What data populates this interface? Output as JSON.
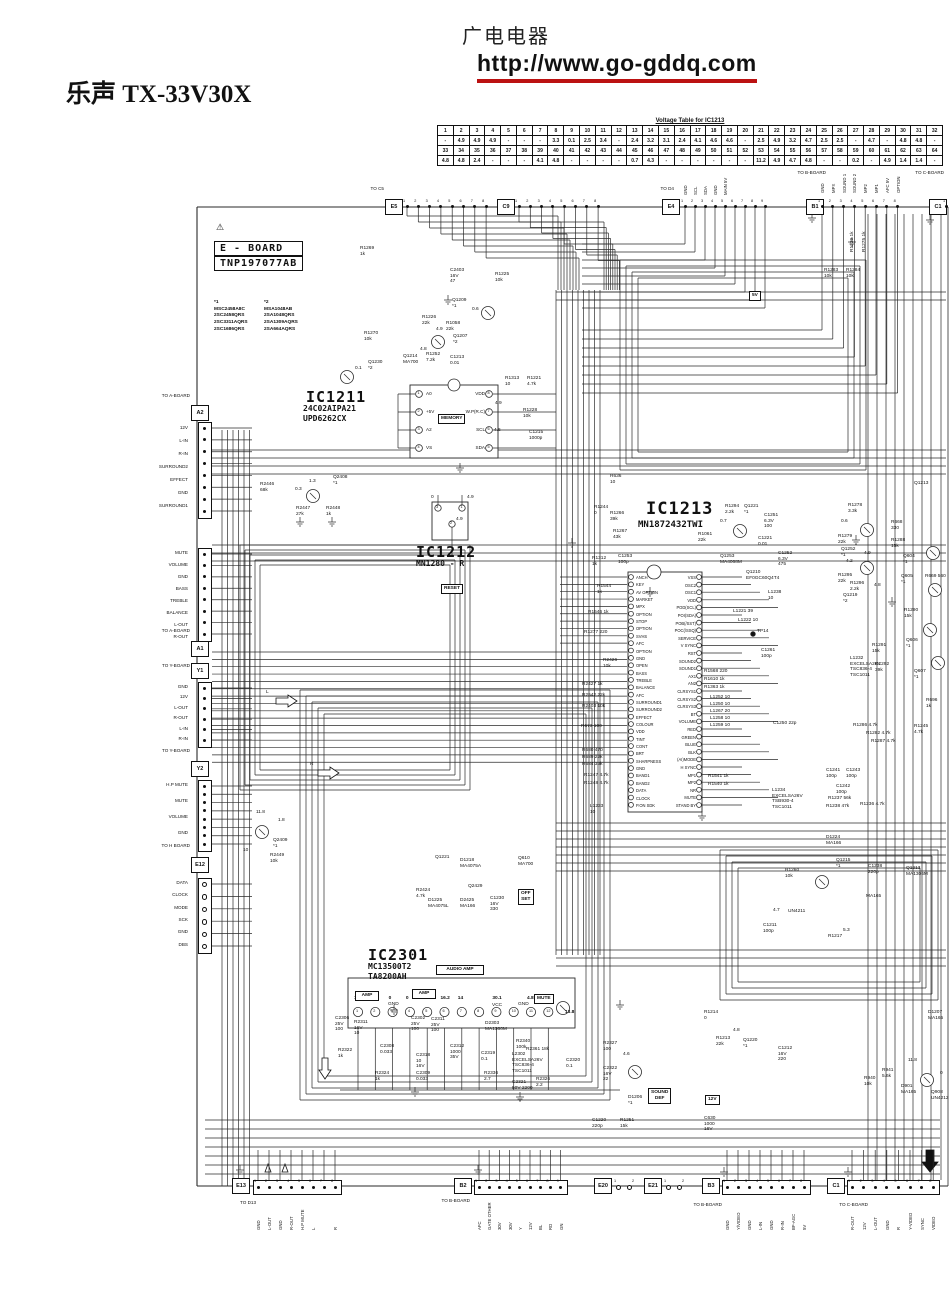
{
  "header": {
    "site_name": "广电电器",
    "site_url": "http://www.go-gddq.com",
    "model_title": "乐声 TX-33V30X"
  },
  "voltage_table": {
    "title": "Voltage Table for IC1213",
    "pins_row1": [
      "1",
      "2",
      "3",
      "4",
      "5",
      "6",
      "7",
      "8",
      "9",
      "10",
      "11",
      "12",
      "13",
      "14",
      "15",
      "16",
      "17",
      "18",
      "19",
      "20",
      "21",
      "22",
      "23",
      "24",
      "25",
      "26",
      "27",
      "28",
      "29",
      "30",
      "31",
      "32"
    ],
    "volts_row1": [
      "-",
      "4.9",
      "4.9",
      "4.9",
      "-",
      "-",
      "-",
      "3.3",
      "0.1",
      "2.5",
      "3.4",
      "-",
      "2.4",
      "3.2",
      "3.1",
      "2.4",
      "4.1",
      "4.6",
      "4.6",
      "-",
      "2.5",
      "4.9",
      "3.2",
      "4.7",
      "2.5",
      "2.5",
      "-",
      "4.7",
      "-",
      "4.8",
      "4.8",
      "-"
    ],
    "pins_row2": [
      "33",
      "34",
      "35",
      "36",
      "37",
      "38",
      "39",
      "40",
      "41",
      "42",
      "43",
      "44",
      "45",
      "46",
      "47",
      "48",
      "49",
      "50",
      "51",
      "52",
      "53",
      "54",
      "55",
      "56",
      "57",
      "58",
      "59",
      "60",
      "61",
      "62",
      "63",
      "64"
    ],
    "volts_row2": [
      "4.8",
      "4.8",
      "2.4",
      "-",
      "-",
      "-",
      "4.1",
      "4.8",
      "-",
      "-",
      "-",
      "-",
      "0.7",
      "4.3",
      "-",
      "-",
      "-",
      "-",
      "-",
      "-",
      "11.2",
      "4.9",
      "4.7",
      "4.8",
      "-",
      "-",
      "0.2",
      "-",
      "4.9",
      "1.4",
      "1.4",
      "-"
    ]
  },
  "eboard": {
    "warning": "⚠",
    "name": "E - BOARD",
    "part": "TNP197077AB"
  },
  "legend": {
    "c1": {
      "title": "*1",
      "items": [
        "MSC2458A8C",
        "2SC2458QRS",
        "2SC3311AQRS",
        "2SC1686QRS"
      ]
    },
    "c2": {
      "title": "*2",
      "items": [
        "MSA1048AB",
        "2SA1048QRS",
        "2SA1309AQRS",
        "2SA664AQRS"
      ]
    }
  },
  "ic1211": {
    "ref": "IC1211",
    "parts": "24C02AIPA21\nUPD6262CX",
    "left_pins": [
      "A0",
      "+5V",
      "A2",
      "VS"
    ],
    "right_pins": [
      "VDD",
      "W.P(R.C)",
      "SCL",
      "SDA"
    ],
    "left_nums": [
      "1",
      "2",
      "3",
      "4"
    ],
    "right_nums": [
      "8",
      "7",
      "6",
      "5"
    ]
  },
  "ic1212": {
    "ref": "IC1212",
    "part": "MN1280 - R",
    "pins": [
      "3",
      "1",
      "2"
    ],
    "values": [
      "0",
      "4.9",
      "4.9"
    ]
  },
  "ic1213": {
    "ref": "IC1213",
    "part": "MN1872432TWI",
    "left_pins": [
      "ANCH",
      "KEY",
      "AV OPTION",
      "MARKET",
      "MPX",
      "OPTION",
      "STOP",
      "OPTION",
      "SVHS",
      "AFC",
      "OPTION",
      "GND",
      "OPEN",
      "BASS",
      "TREBLE",
      "BALANCE",
      "AFC",
      "SURROUND1",
      "SURROUND2",
      "EFFECT",
      "COLOUR",
      "VDD",
      "TINT",
      "CONT",
      "BRT",
      "SHARPNESS",
      "GND",
      "BAND1",
      "BAND2",
      "DATA",
      "CLOCK",
      "P.ON SDK"
    ],
    "right_pins": [
      "VSS",
      "OSC2",
      "OSC1",
      "VDD",
      "POD(SCL)",
      "POI(SDA)",
      "POB(/SST)",
      "POC(/SSQ)",
      "SERVICE",
      "V SYNC",
      "RST",
      "SOUND2",
      "SOUND1",
      "AX1",
      "AN2",
      "CLRSYS1",
      "CLRSYS2",
      "CLRSYS3",
      "BT",
      "VOLUME",
      "RED",
      "GREEN",
      "BLUE",
      "BLK",
      "(AI)MODE",
      "H SYNC",
      "MP1",
      "MP2",
      "NR",
      "MUTE",
      "STAND BY"
    ]
  },
  "ic2301": {
    "ref": "IC2301",
    "parts": "MC13500T2\nTA8200AH",
    "amp_label": "AMP",
    "pins": [
      "1",
      "2",
      "3",
      "4",
      "5",
      "6",
      "7",
      "8",
      "9",
      "10",
      "11",
      "12"
    ],
    "values": [
      "1.5",
      "0",
      "0",
      "0",
      "1.5",
      "16.2",
      "14",
      "",
      "30.1",
      "",
      "4.8",
      ""
    ],
    "v12": "13.8",
    "vcc": "VCC",
    "gnd": "GND"
  },
  "boxed": {
    "v5": "5V",
    "v12": "12V",
    "sound_def": "SOUND\nDEF",
    "off_set": "OFF\nSET",
    "mute": "MUTE",
    "audio_amp": "AUDIO  AMP",
    "memory": "MEMORY",
    "reset": "RESET"
  },
  "connectors": {
    "e5": {
      "to": "TO C5",
      "id": "E5",
      "pins": [
        "1",
        "2",
        "3",
        "4",
        "5",
        "6",
        "7",
        "8"
      ]
    },
    "c9": {
      "id": "C9",
      "pins": [
        "1",
        "2",
        "3",
        "4",
        "5",
        "6",
        "7",
        "8"
      ]
    },
    "e4": {
      "to": "TO D4",
      "id": "E4",
      "pins": [
        "1",
        "2",
        "3",
        "4",
        "5",
        "6",
        "7",
        "8",
        "9"
      ],
      "labels": [
        "GND",
        "SCL",
        "SDA",
        "GND",
        "MAIN 5V"
      ]
    },
    "b1": {
      "to": "TO B-BOARD",
      "id": "B1",
      "pins": [
        "1",
        "2",
        "3",
        "4",
        "5",
        "6",
        "7",
        "8"
      ],
      "labels": [
        "GND",
        "MPX",
        "SOUND 1",
        "SOUND 2",
        "MP2",
        "MP1",
        "AFC 5V",
        "OPTION"
      ]
    },
    "c1_top": {
      "to": "TO C-BOARD",
      "id": "C1",
      "pins": [
        "1"
      ]
    },
    "a2": {
      "to": "TO A-BOARD",
      "id": "A2",
      "labels": [
        "12V",
        "L-IN",
        "R-IN",
        "SURROUND2",
        "EFFECT",
        "GND",
        "SURROUND1"
      ]
    },
    "a1": {
      "to": "TO A-BOARD",
      "id": "A1",
      "labels": [
        "MUTE",
        "VOLUME",
        "GND",
        "BASS",
        "TREBLE",
        "BALANCE",
        "L-OUT",
        "R-OUT"
      ]
    },
    "y1": {
      "to": "TO Y-BOARD",
      "id": "Y1",
      "labels": [
        "GND",
        "12V",
        "L-OUT",
        "R-OUT",
        "L-IN",
        "R-IN"
      ]
    },
    "y2": {
      "to": "TO Y-BOARD",
      "id": "Y2",
      "labels": [
        "H.P MUTE",
        "MUTE",
        "VOLUME",
        "GND"
      ]
    },
    "e12": {
      "to": "TO H BOARD",
      "id": "E12",
      "labels": [
        "DATA",
        "CLOCK",
        "MODE",
        "SCK",
        "GND",
        "DBS"
      ]
    },
    "e13": {
      "to": "TO D13",
      "id": "E13",
      "pins": [
        "1",
        "2",
        "3",
        "4",
        "5",
        "6",
        "7",
        "8"
      ],
      "labels": [
        "GND",
        "L-OUT",
        "GND",
        "R-OUT",
        "H.P MUTE",
        "L",
        "",
        "R"
      ]
    },
    "b2": {
      "to": "TO B-BOARD",
      "id": "B2",
      "pins": [
        "1",
        "2",
        "3",
        "4",
        "5",
        "6",
        "7",
        "8",
        "9"
      ],
      "labels": [
        "AFC",
        "GATE OTHER",
        "30V",
        "30V",
        "Y",
        "12V",
        "BL",
        "RD",
        "GN"
      ]
    },
    "e20": {
      "id": "E20",
      "pins": [
        "1",
        "2"
      ]
    },
    "e21": {
      "id": "E21",
      "pins": [
        "1",
        "2"
      ]
    },
    "b3": {
      "to": "TO B-BOARD",
      "id": "B3",
      "pins": [
        "1",
        "2",
        "3",
        "4",
        "5",
        "6",
        "7",
        "8"
      ],
      "labels": [
        "GND",
        "Y/VIDEO",
        "GND",
        "L-IN",
        "GND",
        "R-IN",
        "BF-AGC",
        "5V"
      ]
    },
    "c1_bot": {
      "to": "TO C-BOARD",
      "id": "C1",
      "pins": [
        "1",
        "2",
        "3",
        "4",
        "5",
        "6",
        "7",
        "8"
      ],
      "labels": [
        "R-OUT",
        "12V",
        "L-OUT",
        "GND",
        "R",
        "Y-VIDEO",
        "SYNC",
        "VIDEO"
      ]
    }
  },
  "components": {
    "r1269": "R1269\n1k",
    "c2403": "C2403\n16V\n47",
    "r1225": "R1225\n10k",
    "q1209": "Q1209\n*1",
    "v06a": "0.6",
    "r1226": "R1226\n22k",
    "r1058": "R1058\n22k",
    "v49a": "4.9",
    "r1270": "R1270\n10k",
    "q1207": "Q1207\n*2",
    "v48a": "4.8",
    "q1214": "Q1214\nMA700",
    "r1252": "R1252\n7.2k",
    "c1213": "C1213\n0.01",
    "q1230": "Q1230\n*2",
    "v01a": "0.1",
    "r1313": "R1313\n10",
    "r1221": "R1221\n4.7k",
    "r1228": "R1228\n10k",
    "c1215": "C1215\n1000p",
    "v49b": "4.9",
    "v46a": "4.6",
    "r2446": "R2446\n68k",
    "q2408": "Q2408\n*1",
    "v13": "1.3",
    "v03": "0.3",
    "r2447": "R2447\n27k",
    "r2448": "R2448\n1k",
    "r1244": "R1244\n0",
    "r1266": "R1266\n39k",
    "r1267": "R1267\n43k",
    "r1312": "R1312\n1k",
    "c1253": "C1253\n100p",
    "r1544": "R1544\n1k",
    "r1546": "R1546  1k",
    "r1277": "R1277  220",
    "r2426": "R2426\n10k",
    "r2427": "R2427  1k",
    "r2542": "R2542  22k",
    "r2403": "R2403  10k",
    "r673": "R673  100",
    "r680": "R680  470",
    "r689": "R689  22k",
    "r684": "R684  33k",
    "r1247": "R1247  4.7k",
    "r1248": "R1248  4.7k",
    "l1233": "L1233\n10",
    "r1294": "R1294\n2.2k",
    "q1221": "Q1221\n*1",
    "v07a": "0.7",
    "c1251": "C1251\n6.3V\n100",
    "r1061": "R1061\n22k",
    "c1221": "C1221\n0.01",
    "q1253": "Q1253\nMA4068M",
    "c1252": "C1252\n6.3V\n475",
    "q1210": "Q1210\nEF0GC60Q4T4",
    "l1238": "L1238\n10",
    "l1221": "L1221 39",
    "l1222": "L1222 10",
    "c1261": "C1261\n100p",
    "r1568": "R1568  220",
    "r1610": "R1610  1k",
    "r1363": "R1363  1k",
    "l1252": "L1252  10",
    "l1250": "L1250  10",
    "l1267": "L1267  20",
    "l1258": "L1258  10",
    "l1259": "L1259  10",
    "c1250": "C1250 22p",
    "r1541": "R1541  1k",
    "r1540": "R1540  1k",
    "l1234": "L1234\nEXCELSA26V\nTSB930-4\nTSC1011",
    "c1241": "C1241\n100p",
    "c1243": "C1243\n100p",
    "c1242": "C1242\n100p",
    "r1237": "R1237 56k",
    "r1238": "R1238 47k",
    "r1236": "R1236 4.7k",
    "d1224": "D1224\nMA166",
    "r1229": "R1229 1k",
    "r1275": "R1275 1k",
    "r1283": "R1283\n10k",
    "r1284": "R1284\n10k",
    "q1213a": "Q1213",
    "r1278": "R1278\n3.3k",
    "v06b": "0.6",
    "r1279": "R1279\n22k",
    "q1252": "Q1252\n*1",
    "v49c": "4.9",
    "v42": "4.2",
    "r1295": "R1295\n22k",
    "r1296": "R1296\n2.2k",
    "v48b": "4.8",
    "q1219": "Q1219\n*2",
    "r668": "R668\n330",
    "r1288": "R1288\n15k",
    "q604": "Q604\n*1",
    "q605": "Q605\n*1",
    "r669": "R669 560",
    "r1290": "R1290\n15k",
    "q606": "Q606\n*1",
    "r1291": "R1291\n15k",
    "l1232": "L1232\nEXCELSA26V\nTSC836-4\nTSC1011",
    "r1292": "R1292\n39k",
    "q607": "Q607\n*1",
    "r696": "R696\n1k",
    "r1286": "R1286 4.7k",
    "r1282": "R1282 4.7k",
    "r1287": "R1287 4.7k",
    "r1245": "R1245\n4.7k",
    "v118a": "11.8",
    "v18": "1.8",
    "q2409": "Q2409\n*1",
    "r2449": "R2449\n10k",
    "v10": "10",
    "q1221m": "Q1221",
    "d1218": "D1218\nMA4075A",
    "q610": "Q610\nMA700",
    "q2429": "Q2429",
    "d1225": "D1225\nMA4075L",
    "d2425": "D2425\nMA166",
    "c1230": "C1230\n16V\n330",
    "r2424": "R2424\n4.7k",
    "r1260": "R1260\n10k",
    "q1215": "Q1215\n*1",
    "c1238": "C1238\n220p",
    "ma165a": "MA165",
    "un4211": "UN4211",
    "q1213b": "Q1213\nMA1306M",
    "v47a": "4.7",
    "c1211": "C1211\n100p",
    "r1217": "R1217",
    "v53": "5.3",
    "c2306": "C2306\n25V\n100",
    "r2311": "R2311\n16V\n10",
    "c2308": "C2308\n0.033",
    "r2322": "R2322\n1k",
    "r2324": "R2324\n1k",
    "c2309": "C2309\n0.033",
    "c2318": "C2318\n10\n16V",
    "c2302": "C2302\n25V\n100",
    "c2311": "C2311\n25V\n100",
    "c2312": "C2312\n1000\n35V",
    "c2319": "C2319\n0.1",
    "r2336": "R2336\n2.7",
    "d2303": "D2303\nMA1360M",
    "r2340": "R2340\n100k",
    "r2361": "R2361 18k",
    "l2302": "L2302\nEXCELSA26V\nTSC836-4\nTSC1011",
    "c2321": "C2321\n50V 2200",
    "r2326": "R2326\n2.2",
    "c2320": "C2320\n0.1",
    "r2327": "R2327\n100",
    "v46b": "4.6",
    "c2322": "C2322\n16V\n22",
    "d1206": "D1206\n*1",
    "c1220": "C1220\n220p",
    "r1251": "R1251\n15k",
    "c630": "C630\n1000\n16V",
    "r1214": "R1214\n0",
    "r1213": "R1213\n22k",
    "q1220": "Q1220\n*1",
    "v48c": "4.8",
    "c1212": "C1212\n16V\n220",
    "d1207": "D1207\nMA165",
    "r940": "R940\n10k",
    "r941": "R941\n5.6k",
    "v118b": "11.8",
    "d901": "D901\nMA165",
    "q908": "Q908\nUN4212",
    "v0": "0",
    "r636": "R636\n10",
    "arrow_l": "L",
    "arrow_r": "R",
    "tp14": "TP14"
  }
}
